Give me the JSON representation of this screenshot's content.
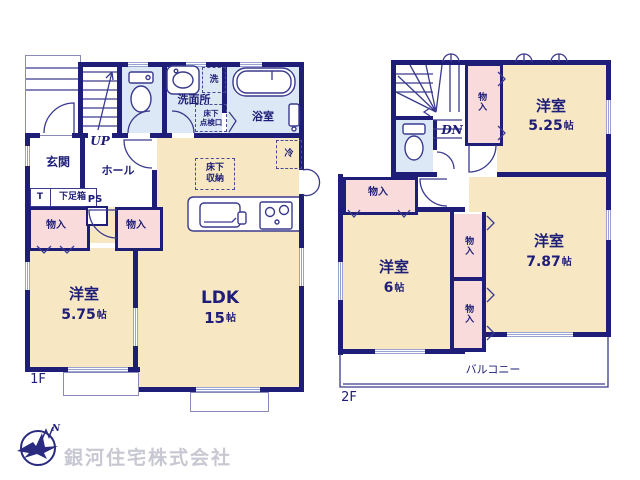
{
  "colors": {
    "wall": "#1e1e78",
    "room_cream": "#f8e7c3",
    "closet_pink": "#f8dbda",
    "wet_blue": "#dde8f6",
    "window_mark": "#99a3d2",
    "text_navy": "#1e1e78",
    "company_gray": "#c8c8d2"
  },
  "company": {
    "name": "銀河住宅株式会社",
    "north_label": "N"
  },
  "floor1": {
    "label": "1F",
    "rooms": {
      "entrance": "玄関",
      "hall": "ホール",
      "washroom": "洗面所",
      "bathroom": "浴室",
      "western": {
        "name": "洋室",
        "size_num": "5.75",
        "size_unit": "帖"
      },
      "ldk": {
        "name": "LDK",
        "size_num": "15",
        "size_unit": "帖"
      }
    },
    "labels": {
      "up": "UP",
      "ps": "PS",
      "t": "T",
      "shoe_box": "下足箱",
      "storage": "物入",
      "washer": "洗",
      "fridge": "冷",
      "underfloor_access_l1": "床下",
      "underfloor_access_l2": "点検口",
      "underfloor_storage_l1": "床下",
      "underfloor_storage_l2": "収納"
    }
  },
  "floor2": {
    "label": "2F",
    "rooms": {
      "room_525": {
        "name": "洋室",
        "size_num": "5.25",
        "size_unit": "帖"
      },
      "room_787": {
        "name": "洋室",
        "size_num": "7.87",
        "size_unit": "帖"
      },
      "room_6": {
        "name": "洋室",
        "size_num": "6",
        "size_unit": "帖"
      },
      "balcony": "バルコニー"
    },
    "labels": {
      "dn": "DN",
      "storage": "物入"
    }
  }
}
